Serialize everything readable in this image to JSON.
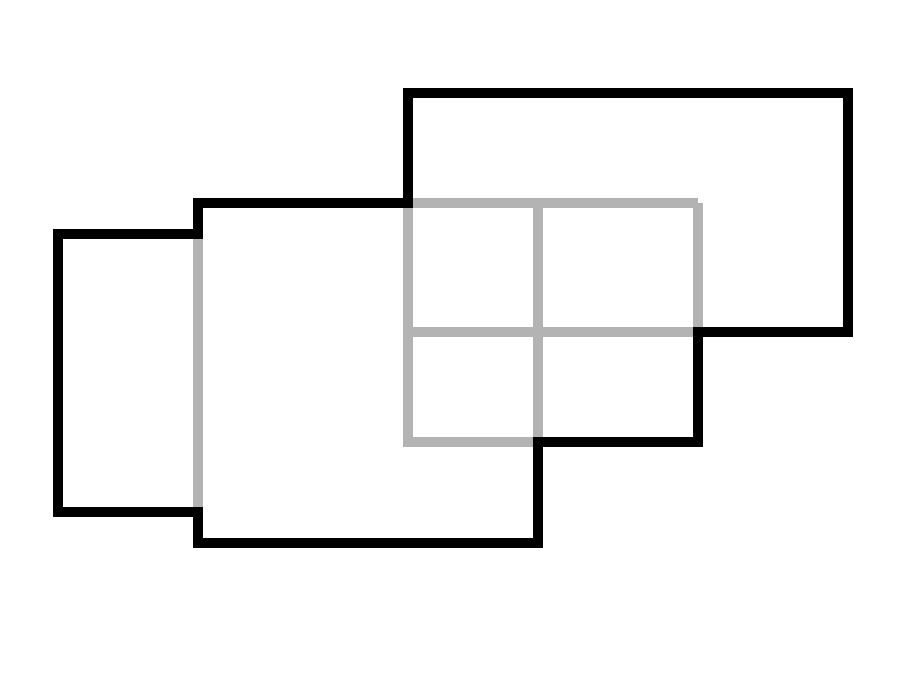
{
  "canvas": {
    "width": 919,
    "height": 686,
    "background": "#ffffff"
  },
  "diagram": {
    "description": "Four overlapping axis-aligned rectangles. The outer union boundary is drawn as a thick black outline; edges hidden inside the union (overlapped edges) are drawn in gray.",
    "stroke_width": 10,
    "colors": {
      "union_outline": "#000000",
      "hidden_edges": "#b3b3b3",
      "background": "#ffffff"
    },
    "rectangles": [
      {
        "name": "left-rectangle",
        "x1": 58,
        "y1": 234,
        "x2": 198,
        "y2": 512
      },
      {
        "name": "middle-rectangle",
        "x1": 198,
        "y1": 203,
        "x2": 538,
        "y2": 543
      },
      {
        "name": "top-right-rectangle",
        "x1": 408,
        "y1": 93,
        "x2": 848,
        "y2": 332
      },
      {
        "name": "inner-rectangle",
        "x1": 408,
        "y1": 203,
        "x2": 698,
        "y2": 442
      }
    ],
    "union_outline_points": [
      [
        58,
        234
      ],
      [
        198,
        234
      ],
      [
        198,
        203
      ],
      [
        408,
        203
      ],
      [
        408,
        93
      ],
      [
        848,
        93
      ],
      [
        848,
        332
      ],
      [
        698,
        332
      ],
      [
        698,
        442
      ],
      [
        538,
        442
      ],
      [
        538,
        543
      ],
      [
        198,
        543
      ],
      [
        198,
        512
      ],
      [
        58,
        512
      ]
    ],
    "hidden_edge_polylines": [
      {
        "name": "inner-rect-top-left-bottom-edges",
        "points": [
          [
            698,
            203
          ],
          [
            408,
            203
          ],
          [
            408,
            442
          ],
          [
            538,
            442
          ]
        ]
      },
      {
        "name": "middle-rect-right-edge-hidden",
        "points": [
          [
            538,
            203
          ],
          [
            538,
            442
          ]
        ]
      },
      {
        "name": "inner-rect-right-edge-hidden",
        "points": [
          [
            698,
            203
          ],
          [
            698,
            332
          ]
        ]
      },
      {
        "name": "top-right-rect-bottom-edge-hidden",
        "points": [
          [
            408,
            332
          ],
          [
            698,
            332
          ]
        ]
      },
      {
        "name": "left-middle-shared-edge-hidden",
        "points": [
          [
            198,
            234
          ],
          [
            198,
            512
          ]
        ]
      }
    ]
  }
}
